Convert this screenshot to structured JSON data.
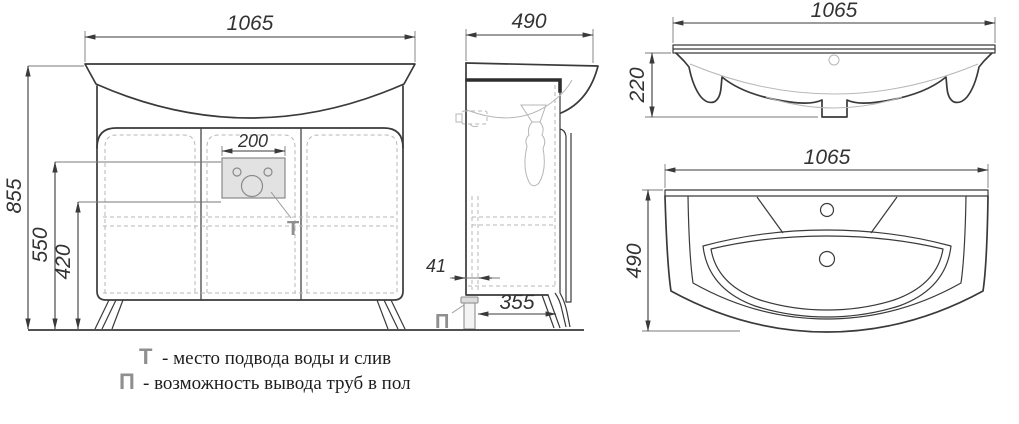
{
  "front_view": {
    "width": "1065",
    "total_height": "855",
    "supply_height": "550",
    "lower_height": "420",
    "panel_width": "200",
    "t_marker": "Т"
  },
  "side_view": {
    "depth": "490",
    "back_gap": "41",
    "pipe_offset": "355",
    "p_marker": "П"
  },
  "basin_front_view": {
    "width": "1065",
    "height": "220"
  },
  "basin_plan_view": {
    "width": "1065",
    "depth": "490"
  },
  "legend": {
    "t_symbol": "Т",
    "t_text": "- место подвода воды и слив",
    "p_symbol": "П",
    "p_text": "- возможность вывода труб в пол"
  },
  "colors": {
    "line": "#3a3a3a",
    "hidden_line": "#b7b7b7",
    "marker_gray": "#8f8f8f",
    "panel_fill": "#e2e2e2"
  }
}
